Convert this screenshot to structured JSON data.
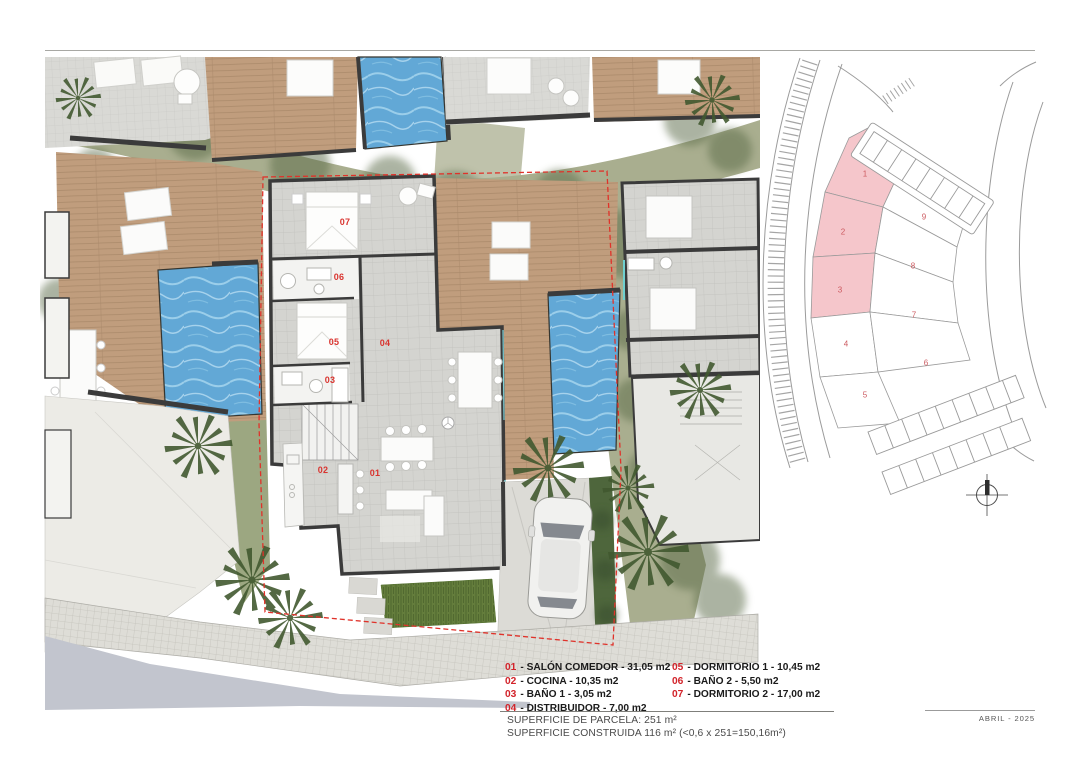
{
  "floor_plan": {
    "room_labels": {
      "r01": "01",
      "r02": "02",
      "r03": "03",
      "r04": "04",
      "r05": "05",
      "r06": "06",
      "r07": "07"
    }
  },
  "site_plan": {
    "plots": [
      {
        "num": "1",
        "highlighted": true
      },
      {
        "num": "2",
        "highlighted": true
      },
      {
        "num": "3",
        "highlighted": true
      },
      {
        "num": "4",
        "highlighted": false
      },
      {
        "num": "5",
        "highlighted": false
      },
      {
        "num": "6",
        "highlighted": false
      },
      {
        "num": "7",
        "highlighted": false
      },
      {
        "num": "8",
        "highlighted": false
      },
      {
        "num": "9",
        "highlighted": false
      }
    ]
  },
  "legend": {
    "col1": [
      {
        "num": "01",
        "rest": "- SALÓN COMEDOR - 31,05 m2"
      },
      {
        "num": "02",
        "rest": "- COCINA - 10,35 m2"
      },
      {
        "num": "03",
        "rest": "- BAÑO 1 - 3,05 m2"
      },
      {
        "num": "04",
        "rest": "- DISTRIBUIDOR - 7,00 m2"
      }
    ],
    "col2": [
      {
        "num": "05",
        "rest": "- DORMITORIO 1 - 10,45 m2"
      },
      {
        "num": "06",
        "rest": "- BAÑO 2 - 5,50 m2"
      },
      {
        "num": "07",
        "rest": "- DORMITORIO 2 - 17,00 m2"
      }
    ]
  },
  "summary": {
    "line1": "SUPERFICIE DE PARCELA: 251 m²",
    "line2": "SUPERFICIE CONSTRUIDA 116 m² (<0,6 x 251=150,16m²)"
  },
  "title_block": {
    "date": "ABRIL - 2025"
  },
  "colors": {
    "accent_red": "#d2232a",
    "room_label_red": "#d9342f",
    "plot_highlight": "#f5c6cb",
    "plot_number": "#cc5a60",
    "pool_blue": "#62a8d6",
    "deck_brown": "#c09d7d",
    "wall_dark": "#3b3b3b",
    "boundary_dashed_red": "#e0322a"
  }
}
